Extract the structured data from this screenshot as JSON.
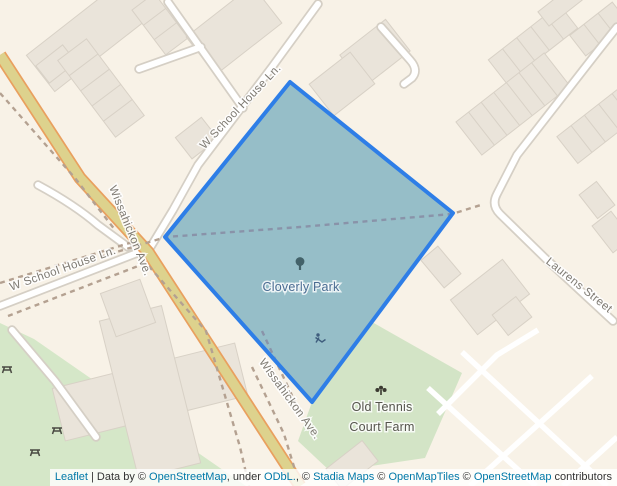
{
  "park": {
    "label": "Cloverly Park"
  },
  "farm": {
    "line1": "Old Tennis",
    "line2": "Court Farm"
  },
  "streets": {
    "school_house_upper": "W School House Ln.",
    "school_house_lower": "W School House Ln.",
    "wissahickon_upper": "Wissahickon Ave.",
    "wissahickon_lower": "Wissahickon Ave.",
    "laurens": "Laurens Street"
  },
  "attribution": {
    "segments": [
      {
        "text": "Leaflet",
        "link": true
      },
      {
        "text": " | Data by © "
      },
      {
        "text": "OpenStreetMap",
        "link": true
      },
      {
        "text": ", under "
      },
      {
        "text": "ODbL.",
        "link": true
      },
      {
        "text": ", © "
      },
      {
        "text": "Stadia Maps",
        "link": true
      },
      {
        "text": " © "
      },
      {
        "text": "OpenMapTiles",
        "link": true
      },
      {
        "text": " © "
      },
      {
        "text": "OpenStreetMap",
        "link": true
      },
      {
        "text": " contributors"
      }
    ]
  },
  "colors": {
    "land": "#f8f2e7",
    "green_area": "#d5e7c8",
    "park_teal": "#93c4cb",
    "highlight_stroke": "#2e7ee7",
    "highlight_fill": "rgba(40,115,225,0.30)",
    "road_major_fill": "#ddd28d",
    "road_major_casing": "#e9a05f",
    "road_minor_fill": "#ffffff",
    "road_minor_casing": "#d5cfc5",
    "path_dashed": "#b4a191",
    "building": "#eae4da",
    "link": "#0078a8"
  }
}
